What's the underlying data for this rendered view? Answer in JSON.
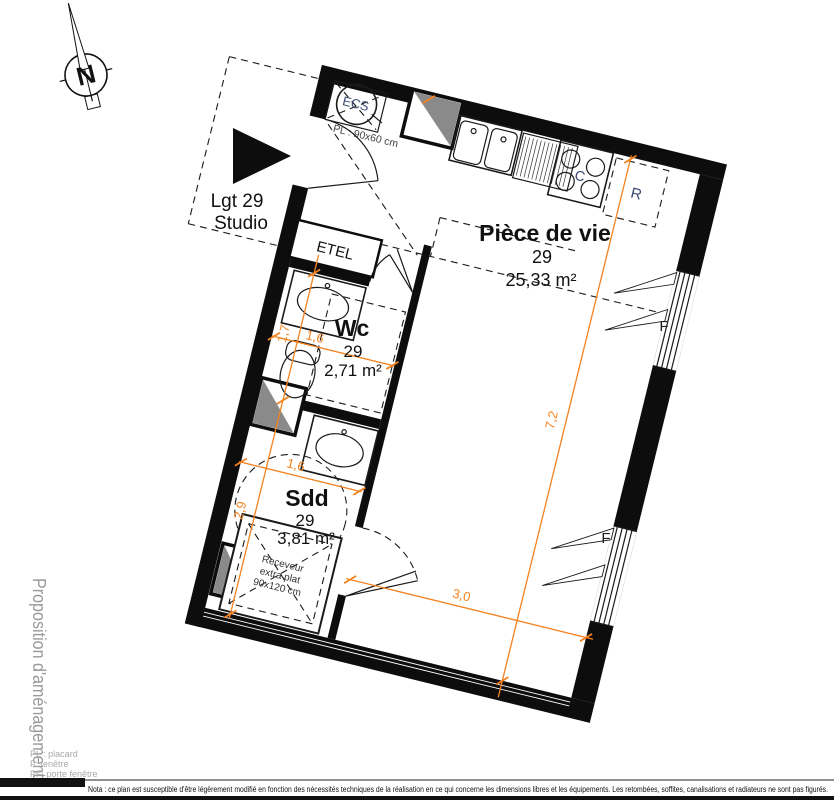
{
  "sidebar": {
    "label": "Proposition d'aménagement"
  },
  "compass": {
    "letter": "N"
  },
  "unit": {
    "line1": "Lgt 29",
    "line2": "Studio"
  },
  "rooms": {
    "living": {
      "name": "Pièce de vie",
      "lot": "29",
      "area": "25,33 m²"
    },
    "wc": {
      "name": "Wc",
      "lot": "29",
      "area": "2,71 m²"
    },
    "bathroom": {
      "name": "Sdd",
      "lot": "29",
      "area": "3,81 m²"
    }
  },
  "fixtures": {
    "water_heater": "ECS",
    "closet_size": "PL : 90x60 cm",
    "electrical_panel": "ETEL",
    "cooktop": "C",
    "fridge": "R",
    "window": "F",
    "shower_line1": "Receveur",
    "shower_line2": "extra plat",
    "shower_line3": "90x120 cm"
  },
  "dimensions": {
    "wc_height": "1,7",
    "wc_width": "1,6",
    "bathroom_width": "1,6",
    "bathroom_height": "2,9",
    "living_height": "7,2",
    "living_width": "3,0"
  },
  "legend": {
    "items": [
      "PL : placard",
      "F: fenêtre",
      "PF: porte fenêtre"
    ]
  },
  "footer": {
    "note": "Nota : ce plan est susceptible d'être légèrement modifié en fonction des nécessités techniques de la réalisation en ce qui concerne les dimensions libres et les équipements. Les retombées, soffites, canalisations et radiateurs ne sont pas figurés."
  },
  "colors": {
    "dimension": "#F5821F",
    "appliance_label": "#3b4a73",
    "muted": "#999999"
  }
}
